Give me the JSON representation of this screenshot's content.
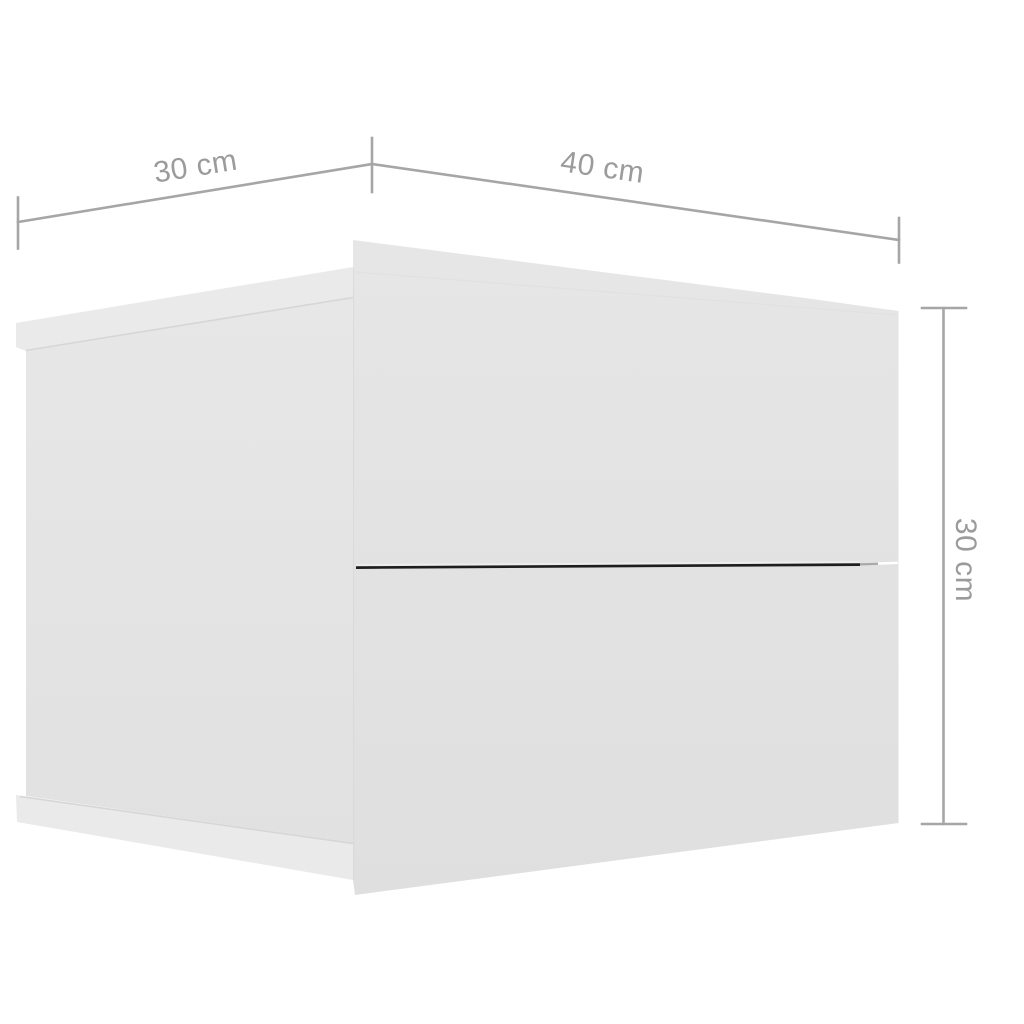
{
  "diagram": {
    "kind": "furniture-dimension-diagram",
    "object": {
      "description": "cabinet with two drawers",
      "drawer_count": 2
    },
    "dimensions": {
      "depth": {
        "label": "30 cm",
        "value": 30,
        "unit": "cm",
        "location": "top-left-edge"
      },
      "width": {
        "label": "40 cm",
        "value": 40,
        "unit": "cm",
        "location": "top-right-edge"
      },
      "height": {
        "label": "30 cm",
        "value": 30,
        "unit": "cm",
        "location": "right-edge"
      }
    },
    "colors": {
      "background": "#ffffff",
      "cabinet_fill": "#e3e3e3",
      "cabinet_fill_light": "#eaeaea",
      "edge_line": "#d6d6d6",
      "dimension_line": "#a6a6a6",
      "dimension_text": "#9b9b9b",
      "drawer_gap": "#1e1e1e"
    }
  }
}
